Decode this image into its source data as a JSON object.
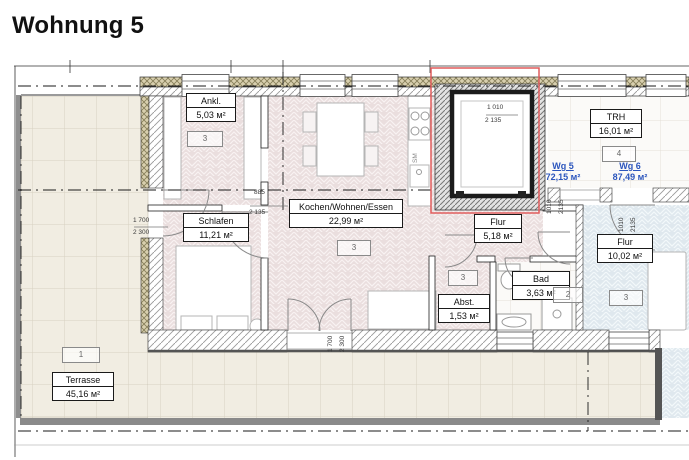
{
  "title": "Wohnung 5",
  "colors": {
    "highlight_red": "#e05c5c",
    "apartment_label_blue": "#2b55bd"
  },
  "rooms": [
    {
      "name": "Ankl.",
      "area": "5,03 м²"
    },
    {
      "name": "Schlafen",
      "area": "11,21 м²"
    },
    {
      "name": "Kochen/Wohnen/Essen",
      "area": "22,99 м²"
    },
    {
      "name": "TRH",
      "area": "16,01 м²"
    },
    {
      "name": "Flur",
      "area": "5,18 м²"
    },
    {
      "name": "Bad",
      "area": "3,63 м²"
    },
    {
      "name": "Abst.",
      "area": "1,53 м²"
    },
    {
      "name": "Flur",
      "area": "10,02 м²"
    },
    {
      "name": "Terrasse",
      "area": "45,16 м²"
    }
  ],
  "apartments": [
    {
      "name": "Wg 5",
      "area": "72,15 м²"
    },
    {
      "name": "Wg 6",
      "area": "87,49 м²"
    }
  ],
  "badges": [
    "3",
    "3",
    "3",
    "2",
    "4",
    "3",
    "1"
  ],
  "dims": {
    "stair_w": "1 010",
    "stair_h": "2 135",
    "schlafen_w": "885",
    "schlafen_h": "2 135",
    "left_door_w": "1 700",
    "left_door_h": "2 300",
    "terrace_door_w": "1 700",
    "terrace_door_h": "2 300",
    "corridor_w": "1010",
    "corridor_h": "2135",
    "wg6_w": "1010",
    "wg6_h": "2135",
    "dishwasher": "SM"
  }
}
